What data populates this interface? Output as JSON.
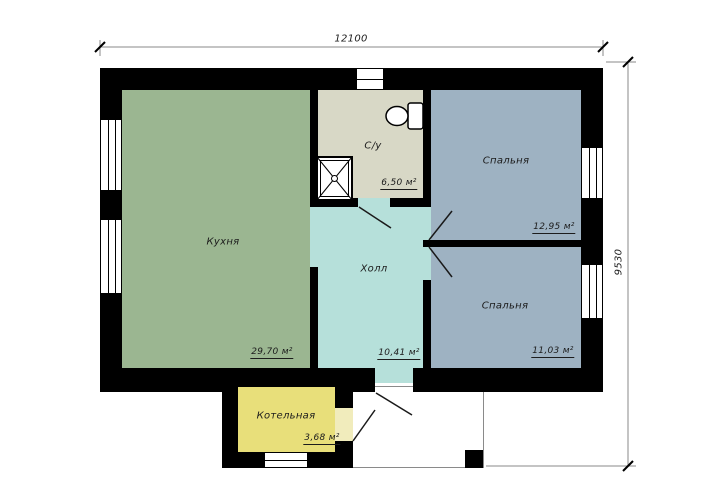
{
  "plan": {
    "dimensions": {
      "width_label": "12100",
      "height_label": "9530"
    },
    "rooms": [
      {
        "id": "kitchen",
        "name": "Кухня",
        "area": "29,70 м²",
        "color": "#9bb691"
      },
      {
        "id": "bathroom",
        "name": "С/у",
        "area": "6,50 м²",
        "color": "#d8d8c6"
      },
      {
        "id": "bedroom-top",
        "name": "Спальня",
        "area": "12,95 м²",
        "color": "#9eb2c2"
      },
      {
        "id": "hall",
        "name": "Холл",
        "area": "10,41 м²",
        "color": "#b6e0da"
      },
      {
        "id": "bedroom-bottom",
        "name": "Спальня",
        "area": "11,03 м²",
        "color": "#9eb2c2"
      },
      {
        "id": "boiler",
        "name": "Котельная",
        "area": "3,68 м²",
        "color": "#e8df7a"
      }
    ],
    "fixtures": [
      {
        "name": "shower"
      },
      {
        "name": "toilet"
      }
    ],
    "colors": {
      "wall": "#000000",
      "window": "#ffffff",
      "boiler_door": "#f1ecbc",
      "dimension_line": "#8a8a8a",
      "text": "#1c1c1c"
    }
  }
}
